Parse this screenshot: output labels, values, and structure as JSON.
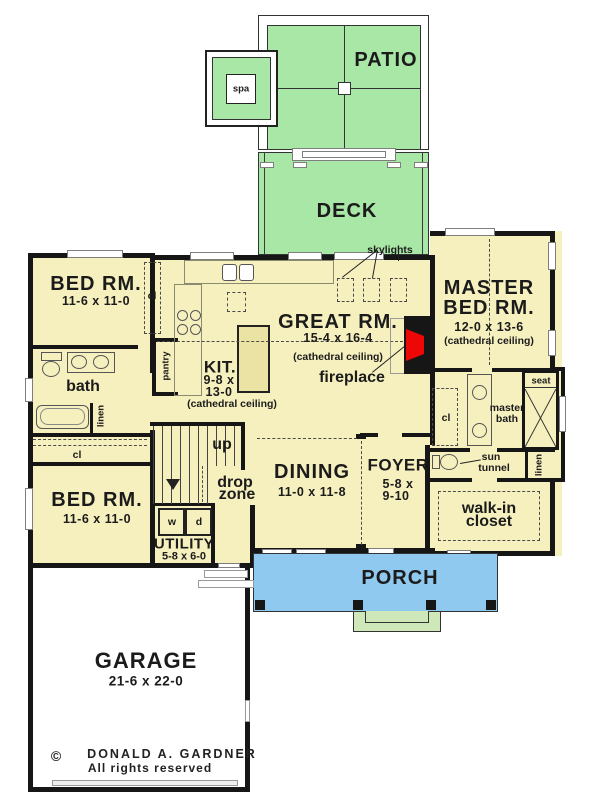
{
  "plan": {
    "patio": {
      "label": "PATIO"
    },
    "spa": {
      "label": "spa"
    },
    "deck": {
      "label": "DECK"
    },
    "skylights": "skylights",
    "bed1": {
      "name": "BED RM.",
      "dims": "11-6 x 11-0"
    },
    "bed2": {
      "name": "BED RM.",
      "dims": "11-6 x 11-0"
    },
    "bath": "bath",
    "pantry": "pantry",
    "linen": "linen",
    "cl": "cl",
    "kitchen": {
      "name": "KIT.",
      "dims1": "9-8 x",
      "dims2": "13-0",
      "note": "(cathedral ceiling)"
    },
    "great": {
      "name": "GREAT RM.",
      "dims": "15-4 x 16-4",
      "note": "(cathedral ceiling)",
      "fireplace": "fireplace"
    },
    "master": {
      "name1": "MASTER",
      "name2": "BED RM.",
      "dims": "12-0 x 13-6",
      "note": "(cathedral ceiling)"
    },
    "masterbath": {
      "name1": "master",
      "name2": "bath",
      "seat": "seat",
      "sun1": "sun",
      "sun2": "tunnel"
    },
    "walkin": {
      "name1": "walk-in",
      "name2": "closet"
    },
    "foyer": {
      "name": "FOYER",
      "dims1": "5-8 x",
      "dims2": "9-10"
    },
    "dining": {
      "name": "DINING",
      "dims": "11-0 x 11-8"
    },
    "stairs": {
      "up": "up",
      "drop1": "drop",
      "drop2": "zone"
    },
    "utility": {
      "name": "UTILITY",
      "dims": "5-8 x 6-0",
      "washer": "w",
      "dryer": "d"
    },
    "porch": {
      "label": "PORCH"
    },
    "garage": {
      "name": "GARAGE",
      "dims": "21-6 x 22-0"
    },
    "footer": {
      "copyright": "©",
      "author": "DONALD A. GARDNER",
      "rights": "All rights reserved"
    }
  },
  "colors": {
    "floor": "#f6f0bf",
    "outdoor_green": "#a9e7a6",
    "steps_green": "#cfe8ba",
    "porch_blue": "#90c9ef",
    "fireplace_red": "#ee0707",
    "wall": "#161616"
  }
}
